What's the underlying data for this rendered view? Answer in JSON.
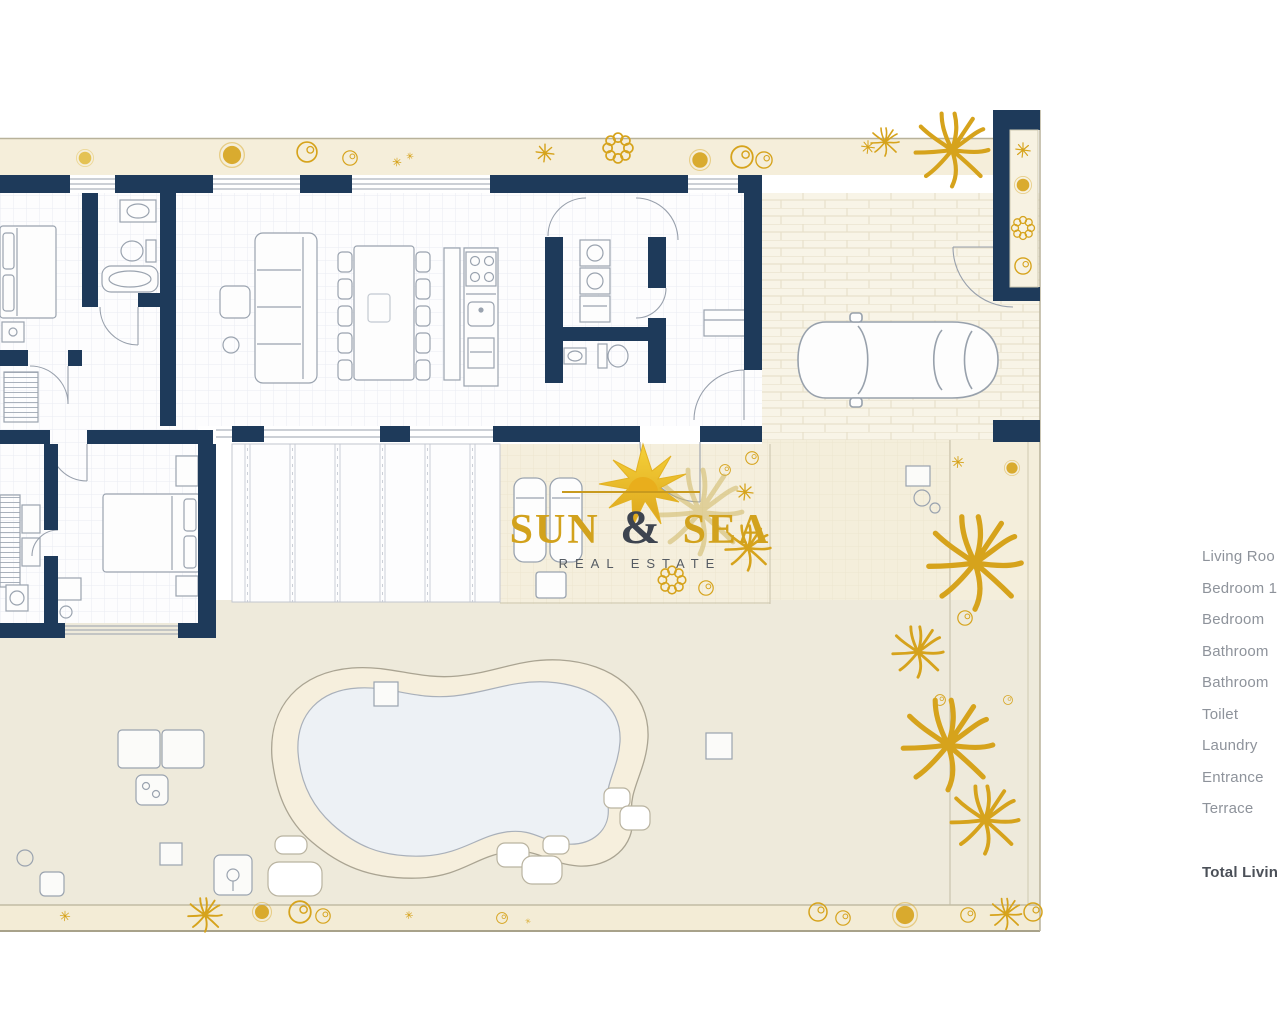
{
  "logo": {
    "sun": "SUN",
    "amp": "&",
    "sea": "SEA",
    "tagline": "REAL ESTATE"
  },
  "legend": {
    "items": [
      "Living Roo",
      "Bedroom 1",
      "Bedroom",
      "Bathroom",
      "Bathroom",
      "Toilet",
      "Laundry",
      "Entrance",
      "Terrace"
    ],
    "total_label": "Total Livin"
  },
  "icons": {
    "logo_mark": "sun-burst"
  },
  "colors": {
    "wall_navy": "#1e3a5a",
    "plant_gold": "#d6a31c",
    "logo_gold": "#d2a21d",
    "garden_beige": "#f4eedb",
    "garden_green_beige": "#eeeadb",
    "pool_water": "#edf1f5",
    "legend_text": "#8e939b",
    "legend_total_text": "#4b5058"
  }
}
